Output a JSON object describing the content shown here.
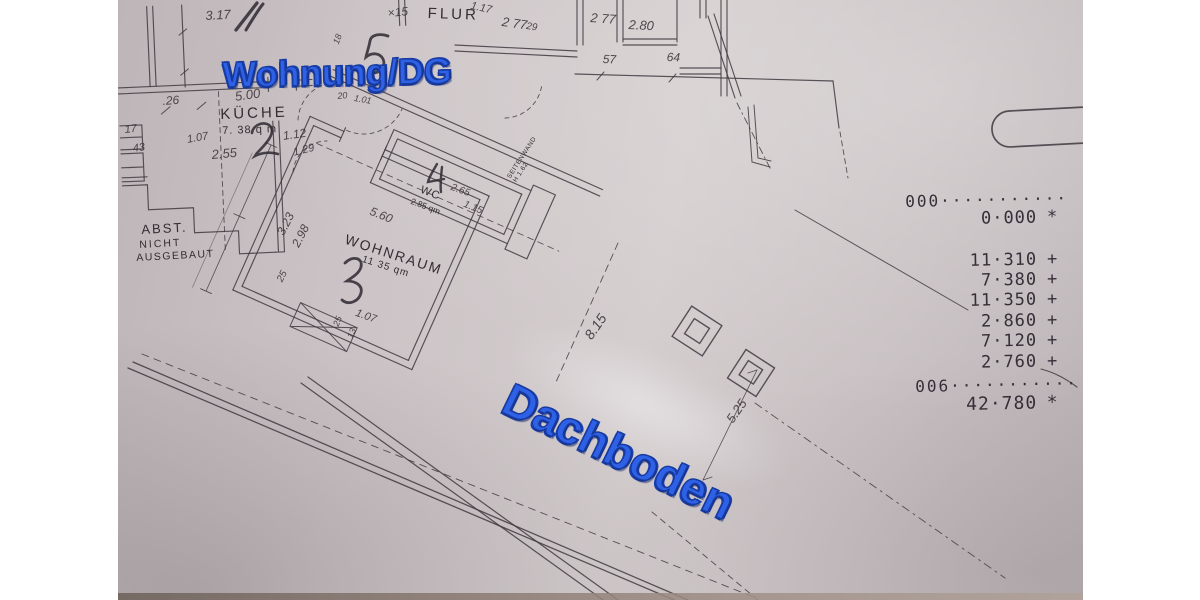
{
  "overlays": {
    "wohnung": "Wohnung/DG",
    "dachboden": "Dachboden"
  },
  "rooms": {
    "flur": "FLUR",
    "kueche": "KÜCHE",
    "kueche_area": "7. 38 q m",
    "wohnraum": "WOHNRAUM",
    "wohnraum_area": "11 35 qm",
    "wc": "WC",
    "wc_area": "2.85 qm",
    "abst_l1": "ABST.",
    "abst_l2": "NICHT",
    "abst_l3": "AUSGEBAUT",
    "seitenwand_l1": "SEITENWAND",
    "seitenwand_l2": "H 1.62"
  },
  "dims": [
    {
      "t": "3.17"
    },
    {
      "t": "×15"
    },
    {
      "t": "1.17"
    },
    {
      "t": "2 77"
    },
    {
      "t": "29"
    },
    {
      "t": "2 77"
    },
    {
      "t": "2.80"
    },
    {
      "t": "57"
    },
    {
      "t": "64"
    },
    {
      "t": ".26"
    },
    {
      "t": "5.00"
    },
    {
      "t": "18"
    },
    {
      "t": "20"
    },
    {
      "t": "1.01"
    },
    {
      "t": "17"
    },
    {
      "t": "43"
    },
    {
      "t": "1.07"
    },
    {
      "t": "2.55"
    },
    {
      "t": "1.12"
    },
    {
      "t": "1.29"
    },
    {
      "t": "3.23"
    },
    {
      "t": "2.98"
    },
    {
      "t": "5.60"
    },
    {
      "t": "25"
    },
    {
      "t": "1.07"
    },
    {
      "t": "25"
    },
    {
      "t": "13"
    },
    {
      "t": "2.65"
    },
    {
      "t": "1.15"
    },
    {
      "t": "8.15"
    },
    {
      "t": "5.25"
    }
  ],
  "tape": {
    "lines": [
      {
        "v": "000···········",
        "op": ""
      },
      {
        "v": "0·000",
        "op": "*"
      },
      {
        "v": "11·310",
        "op": "+"
      },
      {
        "v": "7·380",
        "op": "+"
      },
      {
        "v": "11·350",
        "op": "+"
      },
      {
        "v": "2·860",
        "op": "+"
      },
      {
        "v": "7·120",
        "op": "+"
      },
      {
        "v": "2·760",
        "op": "+"
      },
      {
        "v": "006···········",
        "op": ""
      },
      {
        "v": "42·780",
        "op": "*"
      }
    ]
  }
}
